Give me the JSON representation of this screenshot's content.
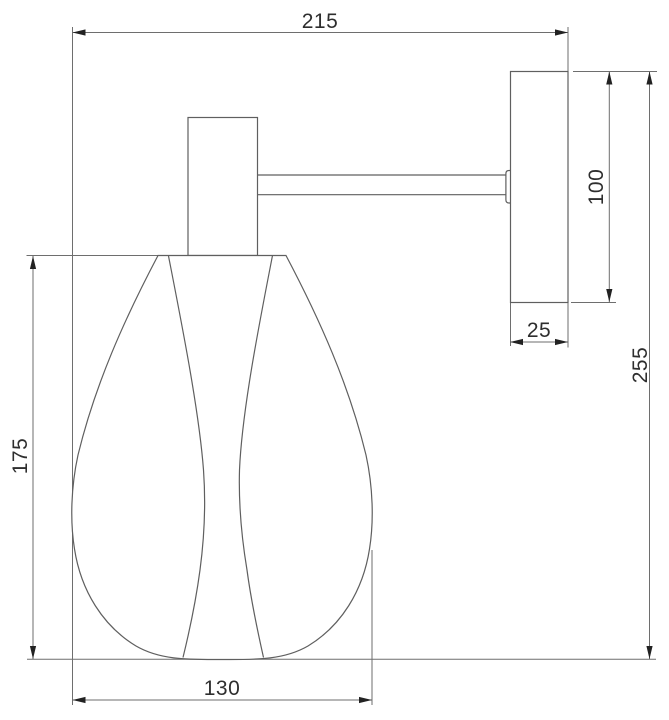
{
  "drawing": {
    "kind": "technical-dimension-drawing",
    "subject": "wall sconce lamp, side elevation with dimensions",
    "dim_labels": {
      "projection_width": "215",
      "backplate_height": "100",
      "backplate_width": "25",
      "overall_height": "255",
      "shade_height": "175",
      "shade_width": "130"
    },
    "colors": {
      "background": "#ffffff",
      "line": "#6e6e6e",
      "object_line": "#5f5f5f",
      "arrow": "#222222",
      "text": "#2e2e2e"
    }
  }
}
